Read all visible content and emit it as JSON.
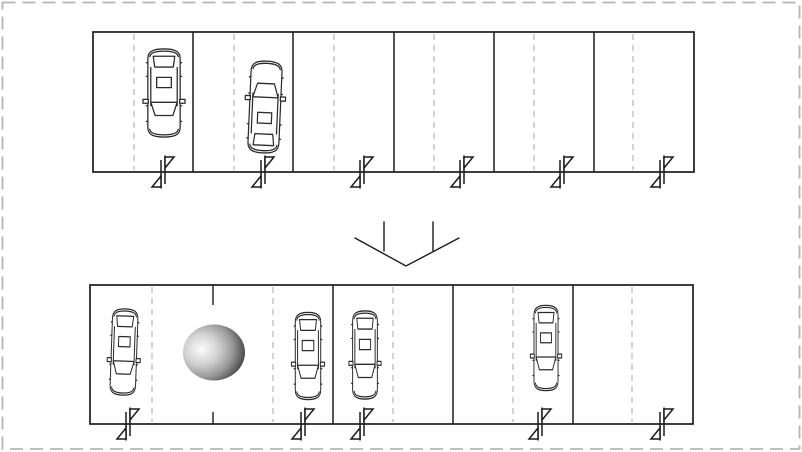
{
  "figure": {
    "title": "parking-lot-reconfiguration-diagram",
    "colors": {
      "background": "#ffffff",
      "page_border": "#b5b5b5",
      "outline": "#1c1c1c",
      "divider": "#1c1c1c",
      "dash_line": "#b3b3b3",
      "car_stroke": "#2a2a2a",
      "arrow": "#1c1c1c",
      "sphere_light": "#fcfcfc",
      "sphere_mid1": "#d2d2d2",
      "sphere_mid2": "#979797",
      "sphere_dark": "#1d1d1d"
    },
    "icons": {
      "car": "car-top-view-icon",
      "gate": "entry-swing-marker-icon",
      "arrow": "down-chevron-arrow",
      "sphere": "obstacle-sphere"
    },
    "page_border": {
      "x": 2.5,
      "y": 2.5,
      "width": 797,
      "height": 446.5,
      "dash": "13 7",
      "stroke_width": 1.8
    },
    "top_row": {
      "x": 93,
      "y": 32,
      "width": 601,
      "height": 140,
      "space_count": 6,
      "dividers_x": [
        193,
        293,
        394,
        494,
        594
      ],
      "dash_lines_x": [
        134,
        234,
        334,
        434,
        534,
        633
      ],
      "gate_markers_x": [
        163,
        263,
        362,
        462,
        562,
        662
      ],
      "cars": [
        {
          "cx": 164,
          "cy": 93,
          "w": 47,
          "h": 94,
          "rotate": 0
        },
        {
          "cx": 265,
          "cy": 107,
          "w": 45,
          "h": 98,
          "rotate": 182.5
        }
      ]
    },
    "arrow": {
      "chevron": [
        [
          355,
          238
        ],
        [
          406,
          266
        ],
        [
          459,
          238
        ]
      ],
      "ticks": [
        {
          "x": 384,
          "y1": 222,
          "y2": 251
        },
        {
          "x": 433,
          "y1": 222,
          "y2": 251
        }
      ],
      "stroke_width": 1.4
    },
    "bottom_row": {
      "x": 90,
      "y": 285,
      "width": 603,
      "height": 139,
      "space_count": 5,
      "dividers_x": [
        333,
        453,
        573
      ],
      "stub_divider": {
        "x": 213,
        "top_length": 20,
        "bottom_length": 12
      },
      "dash_lines_x": [
        152,
        273,
        393,
        513,
        632
      ],
      "gate_markers_x": [
        128,
        303,
        362,
        540,
        662
      ],
      "cars": [
        {
          "cx": 124,
          "cy": 352,
          "w": 37,
          "h": 92,
          "rotate": 2
        },
        {
          "cx": 308,
          "cy": 356,
          "w": 37,
          "h": 93,
          "rotate": 0
        },
        {
          "cx": 365,
          "cy": 355,
          "w": 36,
          "h": 94,
          "rotate": 0
        },
        {
          "cx": 546,
          "cy": 348,
          "w": 35,
          "h": 91,
          "rotate": 0
        }
      ],
      "sphere": {
        "cx": 214,
        "cy": 352.5,
        "rx": 31,
        "ry": 28
      }
    }
  }
}
